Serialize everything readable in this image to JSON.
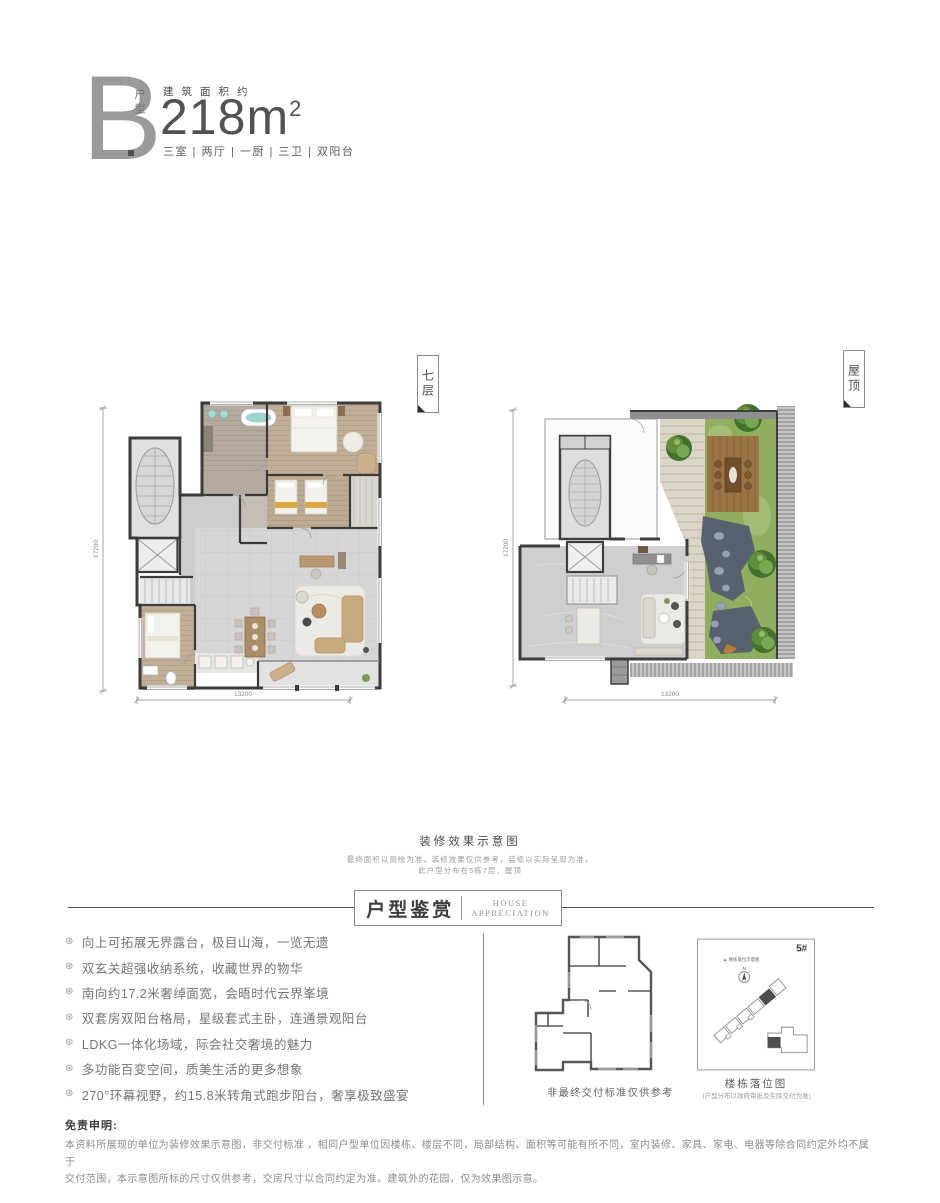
{
  "header": {
    "type_letter": "B",
    "type_label": "户型",
    "area_label": "建筑面积约",
    "area_number": "218",
    "area_unit": "m",
    "area_sup": "2",
    "specs": "三室 | 两厅 | 一厨 | 三卫 | 双阳台"
  },
  "plans": {
    "level7": {
      "tag": "七层",
      "dim_vertical": "17200",
      "dim_horizontal": "13200"
    },
    "roof": {
      "tag": "屋顶",
      "dim_vertical": "17200",
      "dim_horizontal": "13200"
    }
  },
  "render_note": {
    "title": "装修效果示意图",
    "line1": "最终面积以测绘为准，装修效果仅供参考，装修以实际呈现为准，",
    "line2": "此户型分布在5栋7层、屋顶"
  },
  "section_header": {
    "cn": "户型鉴赏",
    "en_line1": "HOUSE",
    "en_line2": "APPRECIATION"
  },
  "features": [
    "向上可拓展无界露台，极目山海，一览无遗",
    "双玄关超强收纳系统，收藏世界的物华",
    "南向约17.2米奢绰面宽，会晤时代云界峯境",
    "双套房双阳台格局，星级套式主卧，连通景观阳台",
    "LDKG一体化场域，际会社交奢境的魅力",
    "多功能百变空间，质美生活的更多想象",
    "270°环幕视野，约15.8米转角式跑步阳台，奢享极致盛宴"
  ],
  "bullet_glyph": "⊛",
  "delivery_plan": {
    "caption": "非最终交付标准仅供参考"
  },
  "location_map": {
    "building_no": "5#",
    "inner_label": "▲ 楼栋落位示意图",
    "compass": "N",
    "caption": "楼栋落位图",
    "subcaption": "(户型分布以政府审批及实际交付为准)"
  },
  "disclaimer": {
    "title": "免责申明:",
    "line1": "本资料所展现的单位为装修效果示意图，非交付标准 ，相同户型单位因楼栋、楼层不同，局部结构、面积等可能有所不同，室内装修、家具、家电、电器等除合同约定外均不属于",
    "line2": "交付范围，本示意图所标的尺寸仅供参考，交房尺寸以合同约定为准。建筑外的花园，仅为效果图示意。"
  },
  "colors": {
    "wall": "#3b3b3b",
    "wood_floor": "#c0ae97",
    "tile_floor": "#d6d6d6",
    "grass": "#8fae5f",
    "deck_wood": "#9c7446",
    "stone_path": "#57626e",
    "tree_green": "#5f8f3d",
    "accent_teal": "#9fd4cf",
    "accent_gold": "#d9a83e",
    "text_dark": "#4a4a4a",
    "text_gray": "#8c8c8c"
  }
}
